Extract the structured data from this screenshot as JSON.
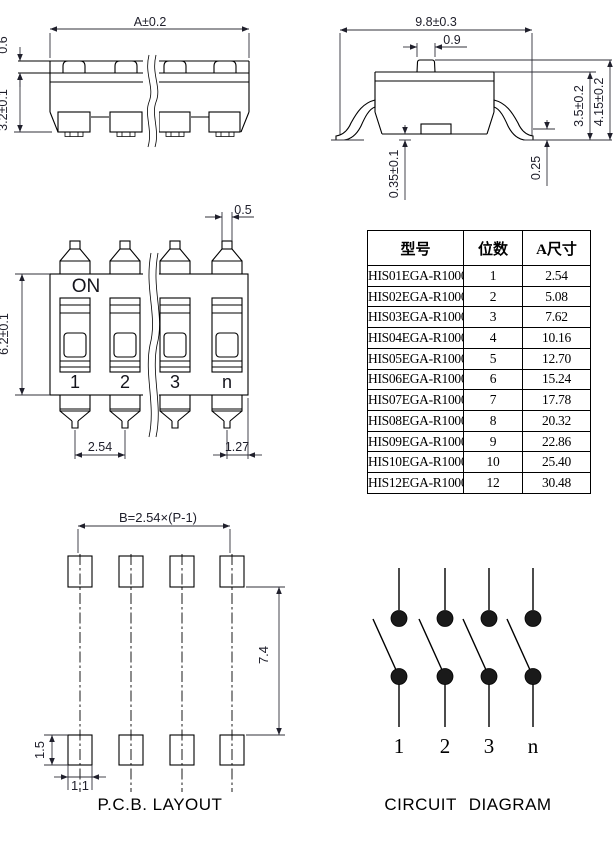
{
  "side_view": {
    "dim_width": "A±0.2",
    "dim_actuator_height": "0.6",
    "dim_body_height": "3.2±0.1"
  },
  "end_view": {
    "dim_width": "9.8±0.3",
    "dim_actuator_width": "0.9",
    "dim_body_height": "3.5±0.2",
    "dim_total_height": "4.15±0.2",
    "dim_standoff": "0.35±0.1",
    "dim_lead_thickness": "0.25"
  },
  "front_view": {
    "on_label": "ON",
    "switch_labels": [
      "1",
      "2",
      "3",
      "n"
    ],
    "dim_lead_width": "0.5",
    "dim_height": "6.2±0.1",
    "dim_pitch": "2.54",
    "dim_end_offset": "1.27"
  },
  "table": {
    "headers": [
      "型号",
      "位数",
      "A尺寸"
    ],
    "rows": [
      [
        "HIS01EGA-R1000",
        "1",
        "2.54"
      ],
      [
        "HIS02EGA-R1000",
        "2",
        "5.08"
      ],
      [
        "HIS03EGA-R1000",
        "3",
        "7.62"
      ],
      [
        "HIS04EGA-R1000",
        "4",
        "10.16"
      ],
      [
        "HIS05EGA-R1000",
        "5",
        "12.70"
      ],
      [
        "HIS06EGA-R1000",
        "6",
        "15.24"
      ],
      [
        "HIS07EGA-R1000",
        "7",
        "17.78"
      ],
      [
        "HIS08EGA-R1000",
        "8",
        "20.32"
      ],
      [
        "HIS09EGA-R1000",
        "9",
        "22.86"
      ],
      [
        "HIS10EGA-R1000",
        "10",
        "25.40"
      ],
      [
        "HIS12EGA-R1000",
        "12",
        "30.48"
      ]
    ]
  },
  "pcb_layout": {
    "dim_span": "B=2.54×(P-1)",
    "dim_row_gap": "7.4",
    "dim_pad_height": "1.5",
    "dim_pad_width": "1.1",
    "caption": "P.C.B. LAYOUT"
  },
  "circuit": {
    "switch_labels": [
      "1",
      "2",
      "3",
      "n"
    ],
    "caption": "CIRCUIT DIAGRAM"
  }
}
